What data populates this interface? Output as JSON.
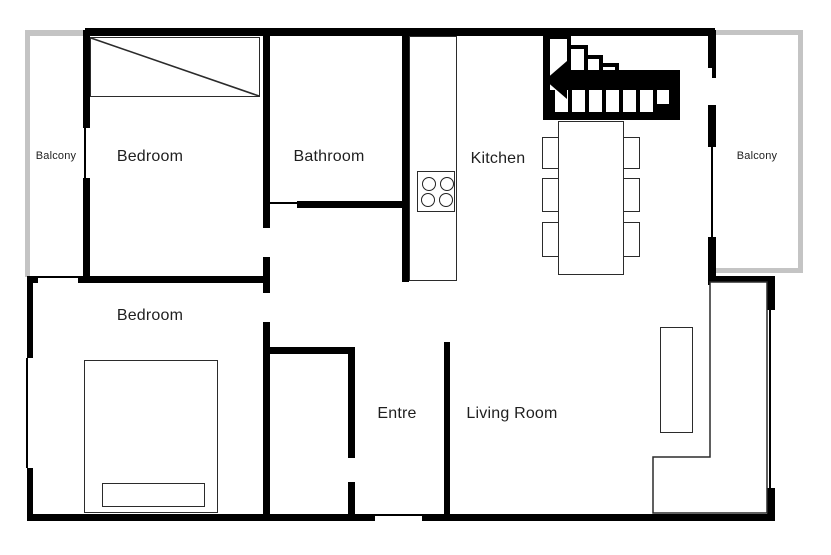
{
  "labels": {
    "bedroom_upper": "Bedroom",
    "bathroom": "Bathroom",
    "kitchen": "Kitchen",
    "balcony_left": "Balcony",
    "balcony_right": "Balcony",
    "bedroom_lower": "Bedroom",
    "entre": "Entre",
    "living_room": "Living Room"
  },
  "colors": {
    "wall": "#000000",
    "balcony_wall": "#c4c4c4",
    "text": "#1f1f1f",
    "furniture_line": "#2b2b2b",
    "background": "#ffffff"
  },
  "symbols": {
    "stairs": "staircase-with-left-arrow",
    "stove": "four-burner-stove",
    "wardrobe": "wardrobe-with-diagonal",
    "bed": "double-bed-with-pillow",
    "dining_set": "table-with-six-chairs",
    "sofa": "l-shaped-sofa",
    "tv_bench": "tv-bench"
  }
}
